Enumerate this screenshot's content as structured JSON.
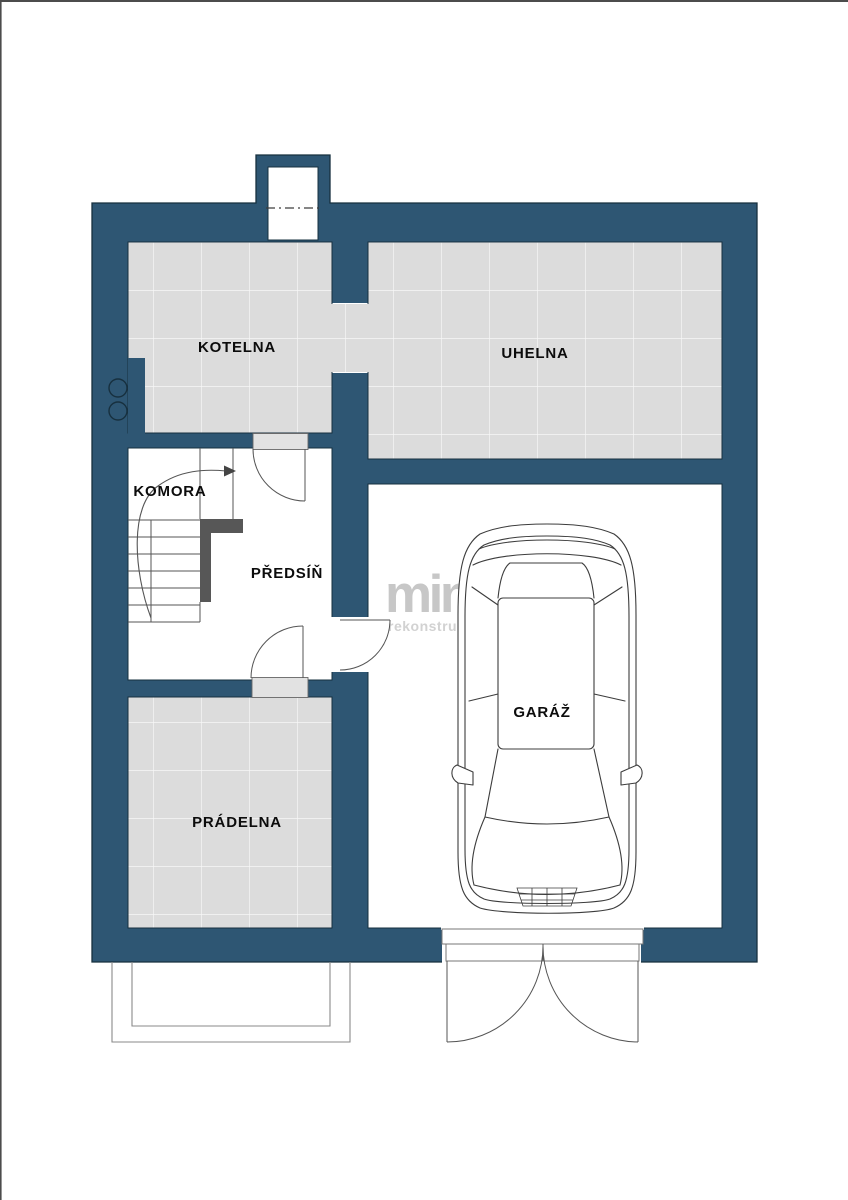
{
  "rooms": {
    "kotelna": {
      "label": "KOTELNA"
    },
    "uhelna": {
      "label": "UHELNA"
    },
    "komora": {
      "label": "KOMORA"
    },
    "predsin": {
      "label": "PŘEDSÍŇ"
    },
    "pradelna": {
      "label": "PRÁDELNA"
    },
    "garaz": {
      "label": "GARÁŽ"
    }
  },
  "watermark": {
    "brand": "mint",
    "tagline": "rekonstrukce"
  },
  "colors": {
    "wall": "#2e5673",
    "wall_outline": "#17303f",
    "tile": "#dcdcdc",
    "tile_grid": "#f7f7f7",
    "line": "#555555",
    "railing": "#575757",
    "watermark_brand": "#c7c7c7",
    "watermark_tagline": "#d2d2d2",
    "label_text": "#0c0c0c"
  }
}
